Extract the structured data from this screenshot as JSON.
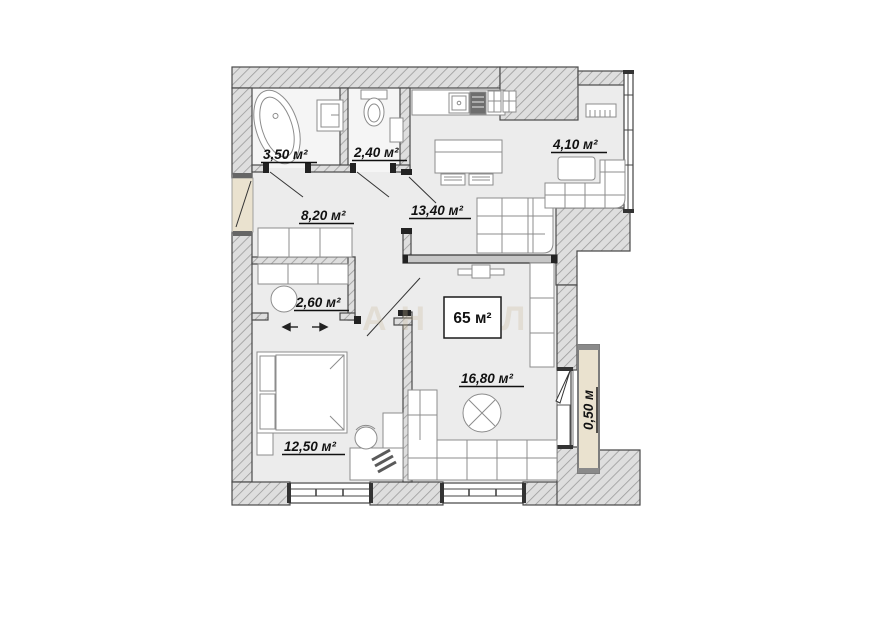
{
  "plan": {
    "rooms": [
      {
        "id": "bathroom",
        "area_label": "3,50 м²"
      },
      {
        "id": "wc",
        "area_label": "2,40 м²"
      },
      {
        "id": "loggia",
        "area_label": "4,10 м²"
      },
      {
        "id": "hallway",
        "area_label": "8,20 м²"
      },
      {
        "id": "kitchen",
        "area_label": "13,40 м²"
      },
      {
        "id": "wardrobe",
        "area_label": "2,60 м²"
      },
      {
        "id": "bedroom",
        "area_label": "12,50 м²"
      },
      {
        "id": "living_room",
        "area_label": "16,80 м²"
      },
      {
        "id": "balcony",
        "area_label": "0,50 м"
      }
    ],
    "total_area_label": "65 м²",
    "watermark_text": "АН АЛ",
    "colors": {
      "wall_fill": "#dedede",
      "wall_hatch_line": "#9b9b9b",
      "wall_outline": "#4a4a4a",
      "floor": "#ececec",
      "floor_light": "#f5f5f5",
      "beige": "#eae2cf",
      "furniture_line": "#8c8c8c",
      "label_color": "#111111"
    }
  }
}
